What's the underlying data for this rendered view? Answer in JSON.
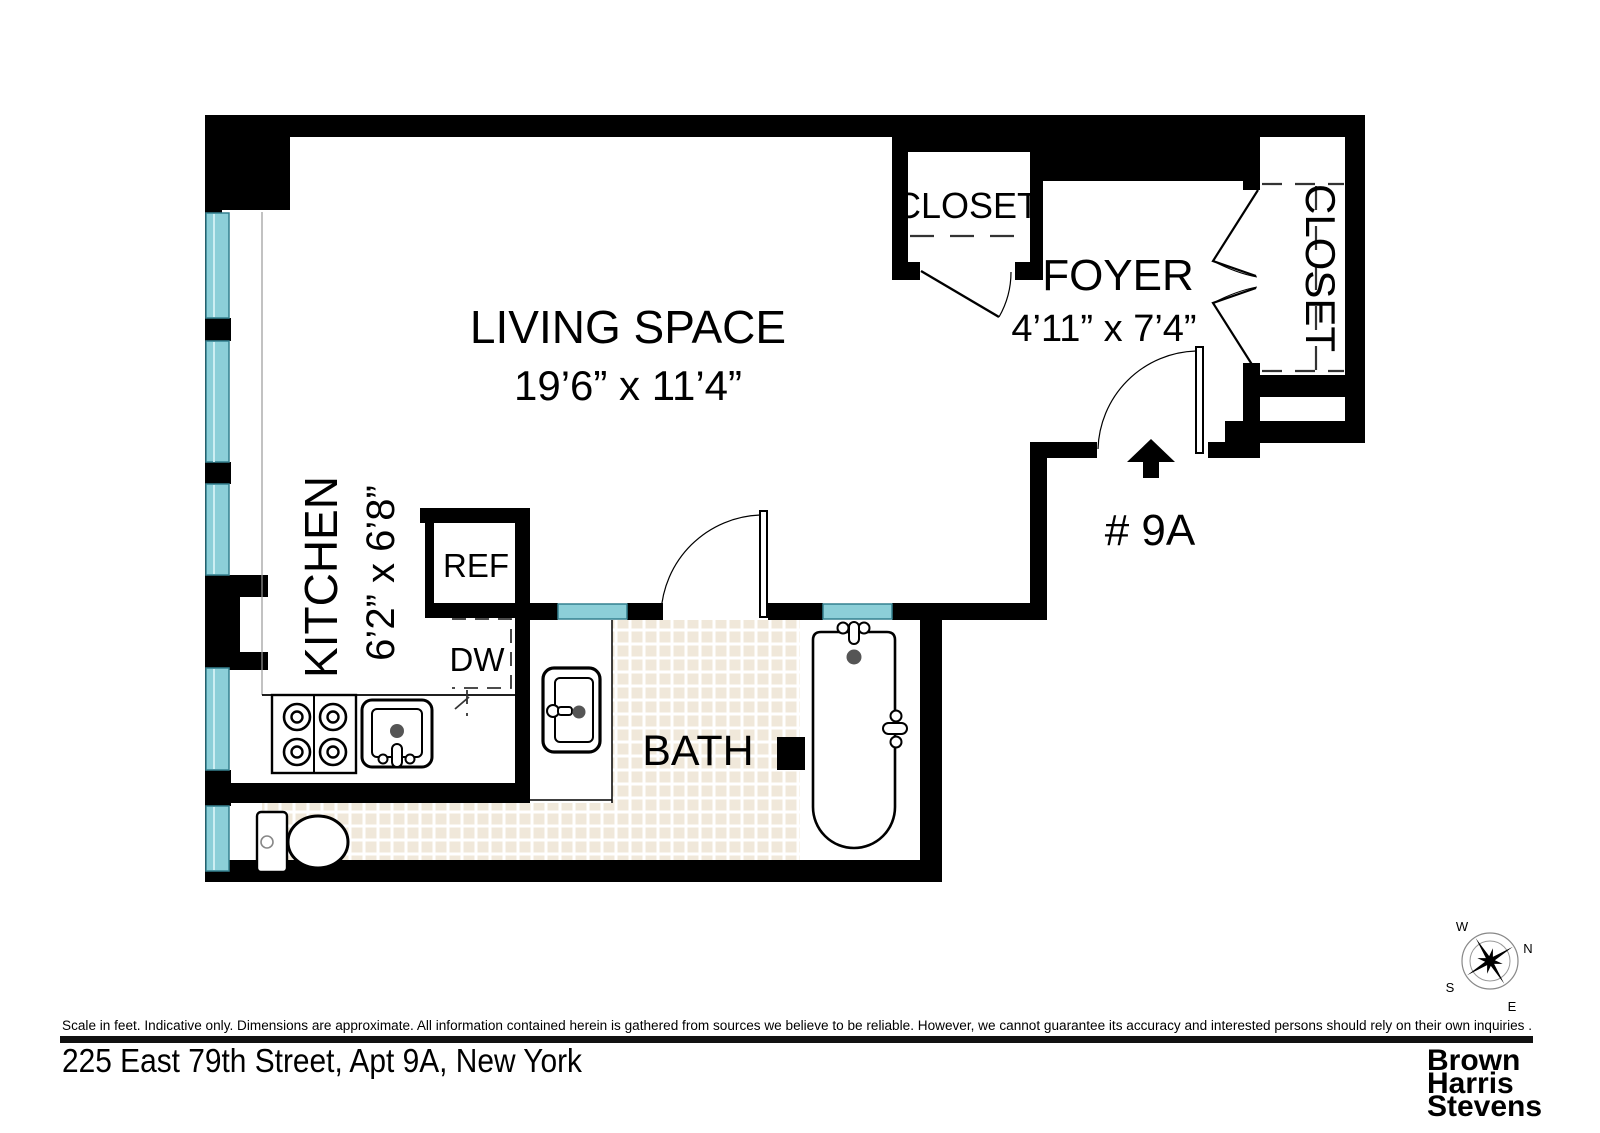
{
  "plan": {
    "rooms": {
      "living": {
        "name": "LIVING SPACE",
        "dims": "19’6” x 11’4”"
      },
      "foyer": {
        "name": "FOYER",
        "dims": "4’11” x 7’4”"
      },
      "kitchen": {
        "name": "KITCHEN",
        "dims": "6’2” x 6’8”"
      },
      "bath": {
        "name": "BATH"
      },
      "closet_top": {
        "name": "CLOSET"
      },
      "closet_right": {
        "name": "CLOSET"
      }
    },
    "fixtures": {
      "ref": "REF",
      "dw": "DW"
    },
    "unit_label": "# 9A",
    "compass": {
      "n": "N",
      "s": "S",
      "e": "E",
      "w": "W"
    }
  },
  "footer": {
    "disclaimer": "Scale in feet. Indicative only. Dimensions are approximate. All information contained herein is gathered from sources we believe to be reliable. However, we cannot guarantee its accuracy and interested persons should rely on their own inquiries .",
    "address": "225 East 79th Street, Apt 9A, New York",
    "brand": {
      "line1": "Brown",
      "line2": "Harris",
      "line3": "Stevens"
    }
  },
  "colors": {
    "wall": "#000000",
    "window_fill": "#8ccfd8",
    "window_edge": "#35818f",
    "tile": "#f0e8da",
    "logo_gray": "#4a4a4c",
    "fixture_dot": "#555555"
  }
}
